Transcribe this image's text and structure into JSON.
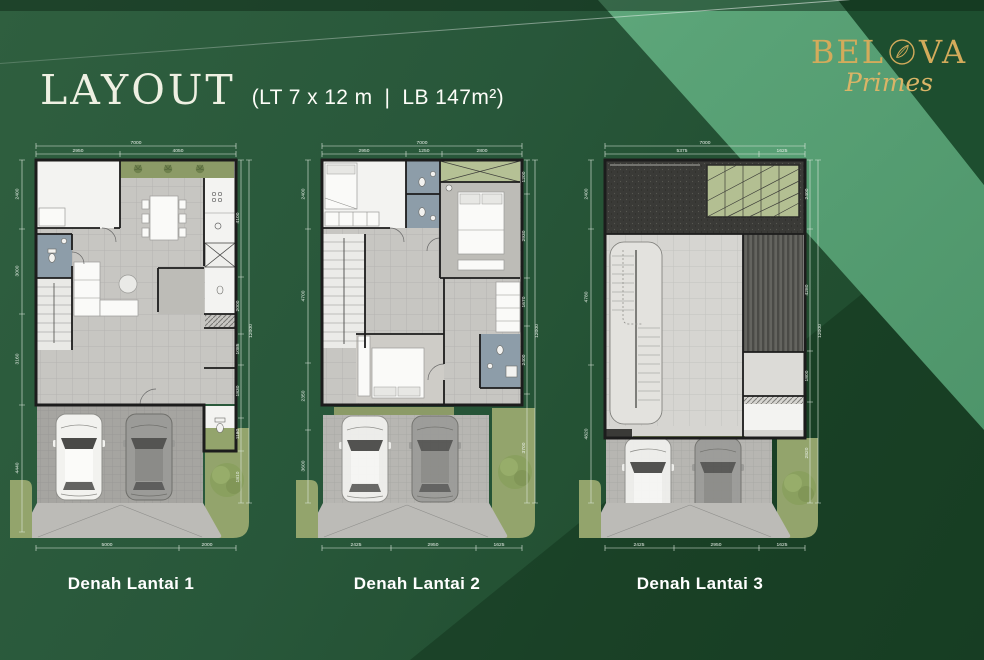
{
  "header": {
    "title": "LAYOUT",
    "subtitle_left": "(LT 7 x 12 m",
    "subtitle_sep": "|",
    "subtitle_right": "LB 147m²)"
  },
  "logo": {
    "name_left": "BEL",
    "name_right": "VA",
    "script": "Primes",
    "emblem": "leaf-medallion"
  },
  "plans": [
    {
      "caption": "Denah Lantai 1",
      "dims": {
        "top_total": "7000",
        "top": [
          "2950",
          "4050"
        ],
        "left": [
          "2400",
          "3000",
          "3160",
          "4440"
        ],
        "right": [
          "4100",
          "2000",
          "1085",
          "1830",
          "1180",
          "1810"
        ],
        "right_total": "12000",
        "bottom": [
          "5000",
          "2000"
        ]
      }
    },
    {
      "caption": "Denah Lantai 2",
      "dims": {
        "top_total": "7000",
        "top": [
          "2950",
          "1250",
          "2800"
        ],
        "left": [
          "2400",
          "4700",
          "2350",
          "3600"
        ],
        "right": [
          "1200",
          "2930",
          "1670",
          "2400",
          "3700"
        ],
        "right_total": "12000",
        "bottom": [
          "2425",
          "2950",
          "1625"
        ]
      }
    },
    {
      "caption": "Denah Lantai 3",
      "dims": {
        "top_total": "7000",
        "top": [
          "5375",
          "1625"
        ],
        "left": [
          "2400",
          "4780",
          "4820"
        ],
        "right": [
          "2400",
          "4280",
          "1800",
          "2820"
        ],
        "right_total": "12000",
        "bottom": [
          "2425",
          "2950",
          "1625"
        ]
      }
    }
  ],
  "colors": {
    "background_dark": "#27563a",
    "background_darker": "#1d4a2c",
    "light_band": "#5aa377",
    "corner_dark": "#1d4e2f",
    "gold": "#d3ab5b",
    "wall": "#1c1c1c",
    "bath_floor": "#8d9da9",
    "grass": "#93a46c",
    "roof_deck": "#3a3a37"
  }
}
